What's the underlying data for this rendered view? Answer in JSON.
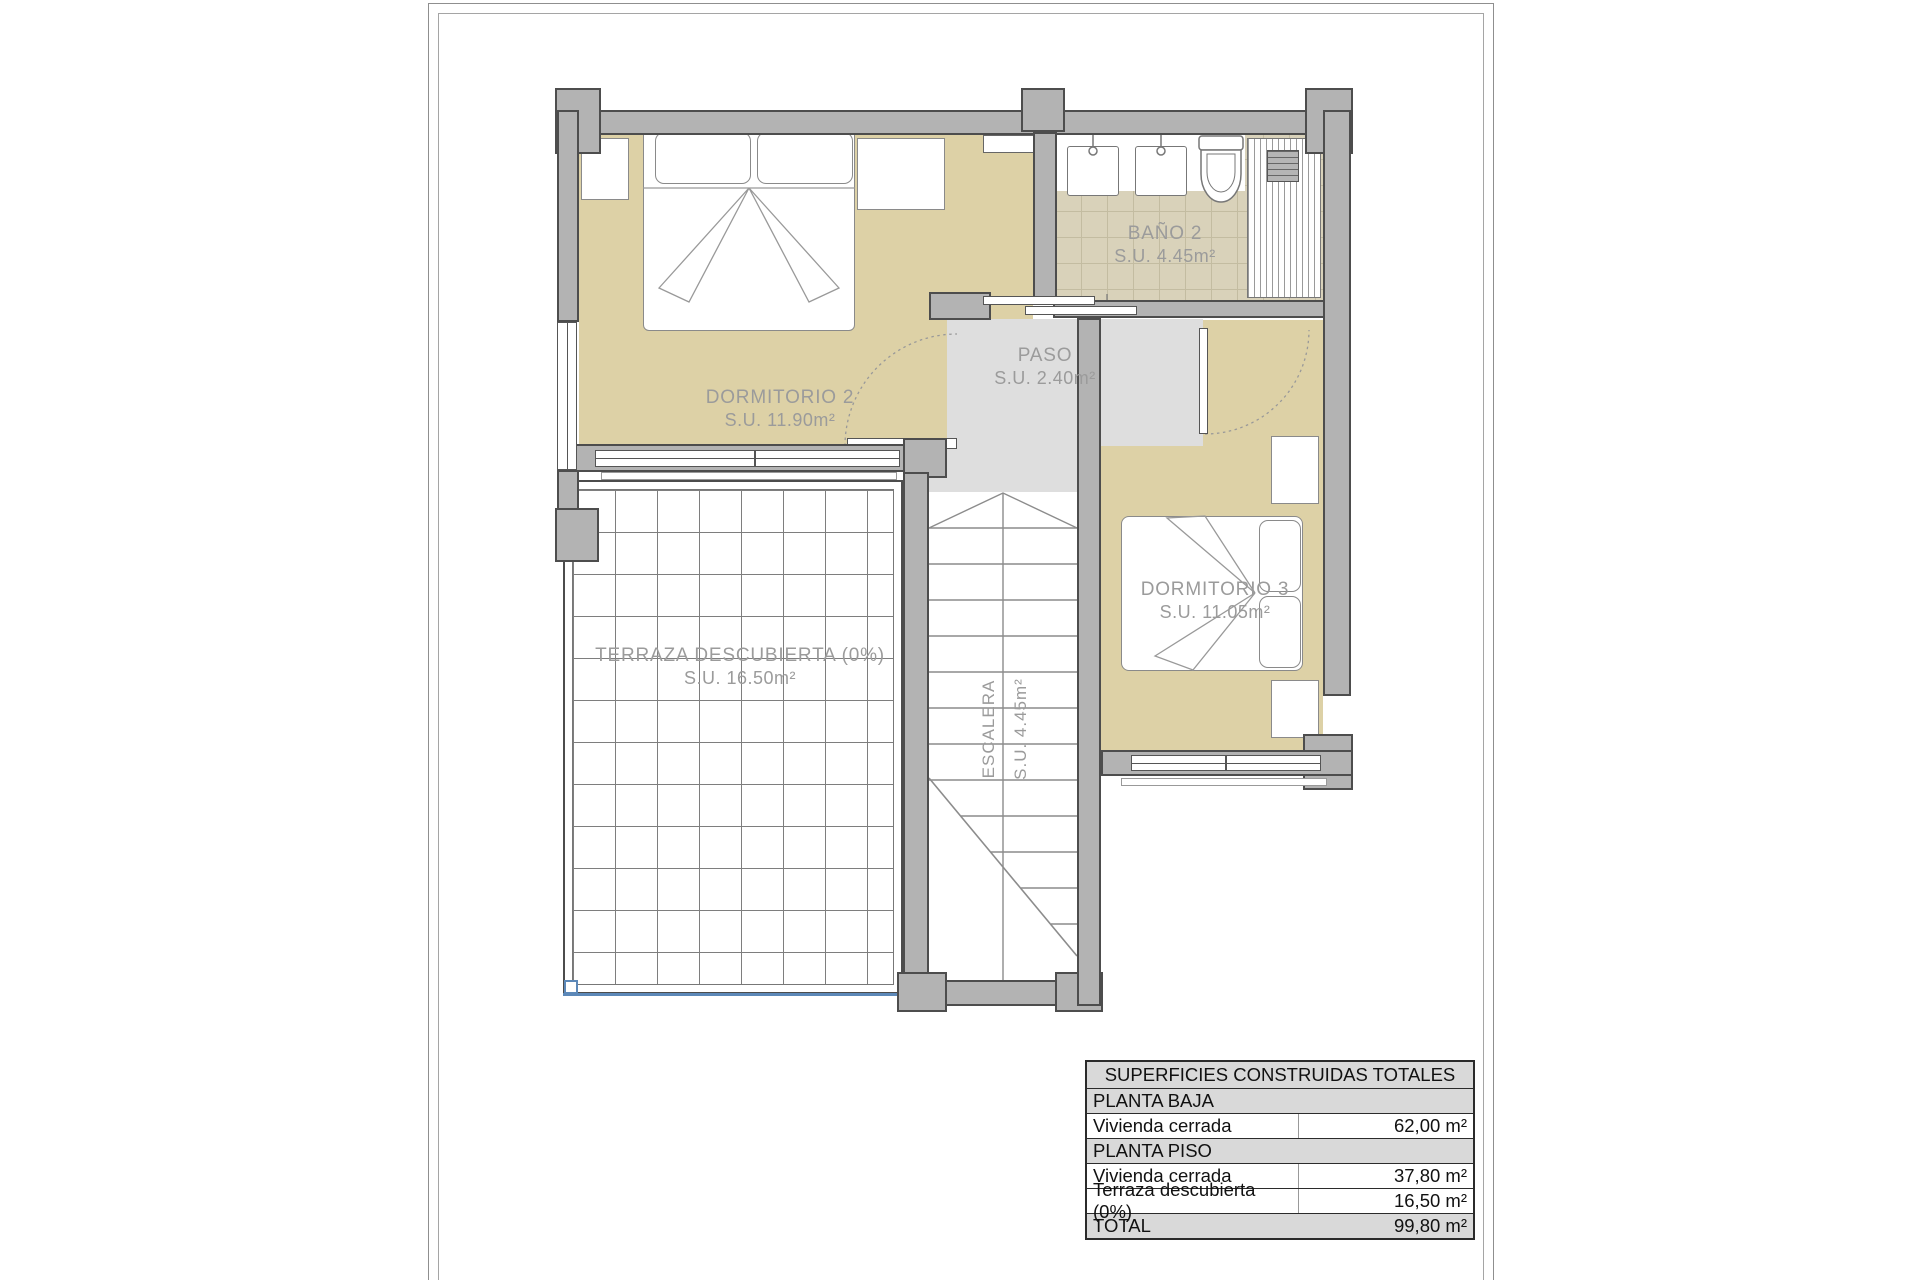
{
  "plan": {
    "rooms": {
      "dormitorio2": {
        "name": "DORMITORIO 2",
        "area": "S.U. 11.90m²"
      },
      "bano2": {
        "name": "BAÑO 2",
        "area": "S.U. 4.45m²"
      },
      "paso": {
        "name": "PASO",
        "area": "S.U. 2.40m²"
      },
      "dormitorio3": {
        "name": "DORMITORIO 3",
        "area": "S.U. 11.05m²"
      },
      "terraza": {
        "name": "TERRAZA DESCUBIERTA (0%)",
        "area": "S.U. 16.50m²"
      },
      "escalera": {
        "name": "ESCALERA",
        "area": "S.U. 4.45m²"
      }
    },
    "colors": {
      "room_fill": "#ddd1a6",
      "tile_fill": "#d9d2ba",
      "paso_fill": "#dedede",
      "wall_fill": "#b3b3b3",
      "wall_outline": "#4d4d4d",
      "label_text": "#9b9b9b",
      "terrace_edge": "#5c88b8"
    }
  },
  "table": {
    "title": "SUPERFICIES CONSTRUIDAS TOTALES",
    "rows": [
      {
        "label": "PLANTA BAJA"
      },
      {
        "label": "Vivienda cerrada",
        "value": "62,00 m²"
      },
      {
        "label": "PLANTA PISO"
      },
      {
        "label": "Vivienda cerrada",
        "value": "37,80 m²"
      },
      {
        "label": "Terraza descubierta (0%)",
        "value": "16,50 m²"
      },
      {
        "label": "TOTAL",
        "value": "99,80 m²"
      }
    ]
  }
}
